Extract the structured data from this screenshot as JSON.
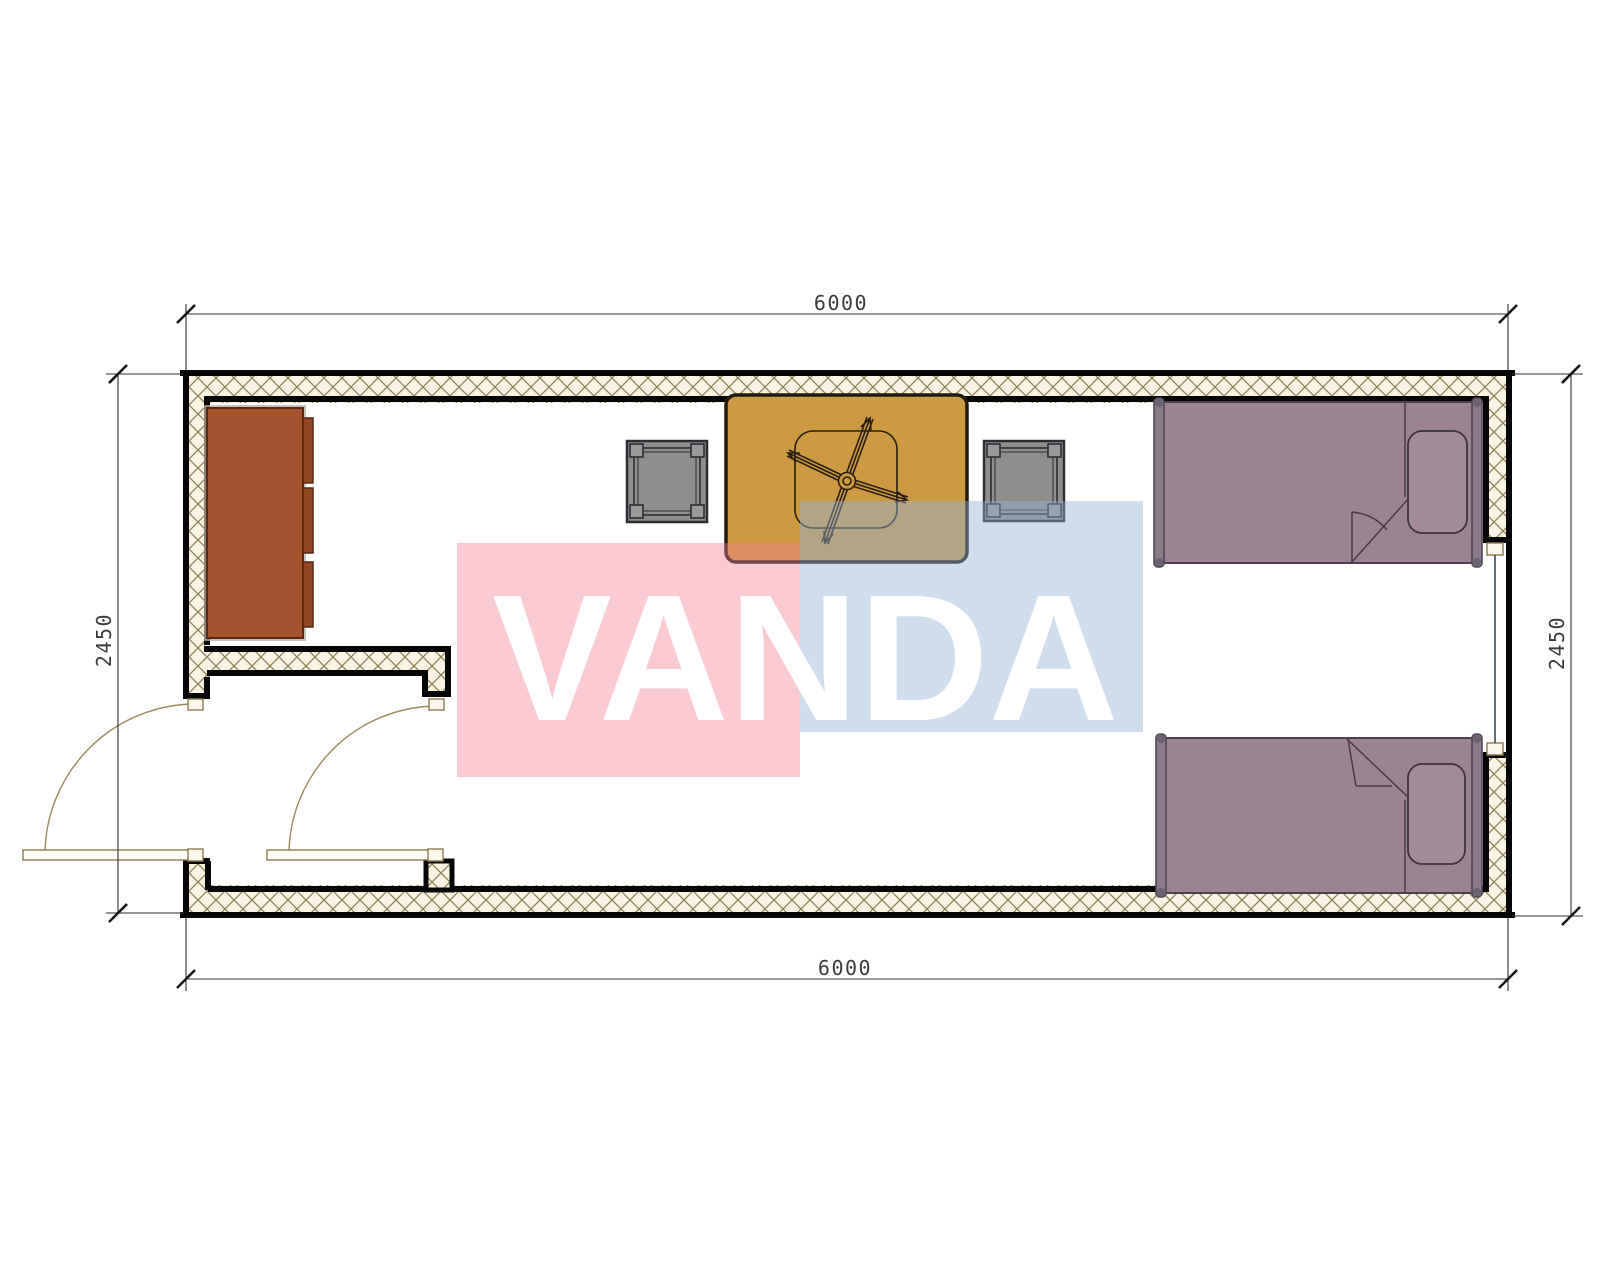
{
  "drawing": {
    "type": "container-house-floor-plan",
    "dimensions": {
      "top": "6000",
      "bottom": "6000",
      "left": "2450",
      "right": "2450"
    },
    "watermark": {
      "text": "VANDA",
      "pink_block_color": "#f2809a",
      "blue_block_color": "#92b1d6"
    },
    "walls": {
      "hatch_background": "#f8f3e3",
      "hatch_line_color": "#8f8258",
      "outline_color": "#060606"
    },
    "furniture": [
      {
        "name": "wardrobe-cabinet",
        "color": "#a3532e"
      },
      {
        "name": "stool-left",
        "color": "#8e8e8e"
      },
      {
        "name": "stool-right",
        "color": "#8e8e8e"
      },
      {
        "name": "table-with-ceiling-fan",
        "color": "#cd9a44"
      },
      {
        "name": "single-bed-top",
        "color": "#9c8392"
      },
      {
        "name": "single-bed-bottom",
        "color": "#9c8392"
      }
    ],
    "openings": {
      "doors": 2,
      "windows": 1
    }
  }
}
